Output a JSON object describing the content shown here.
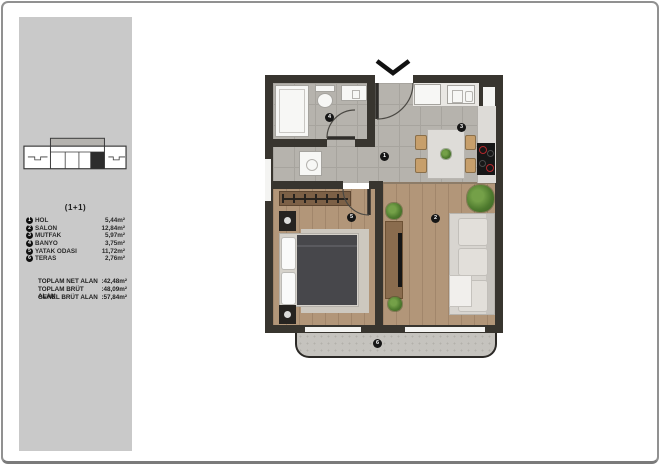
{
  "sidebar": {
    "plan_type": "(1+1)",
    "rooms": [
      {
        "num": "1",
        "label": "HOL",
        "area": "5,44m²"
      },
      {
        "num": "2",
        "label": "SALON",
        "area": "12,84m²"
      },
      {
        "num": "3",
        "label": "MUTFAK",
        "area": "5,97m²"
      },
      {
        "num": "4",
        "label": "BANYO",
        "area": "3,75m²"
      },
      {
        "num": "5",
        "label": "YATAK ODASI",
        "area": "11,72m²"
      },
      {
        "num": "6",
        "label": "TERAS",
        "area": "2,76m²"
      }
    ],
    "totals": [
      {
        "label": "TOPLAM NET ALAN",
        "value": ":42,48m²"
      },
      {
        "label": "TOPLAM BRÜT ALAN",
        "value": ":48,09m²"
      },
      {
        "label": "GENEL BRÜT ALAN",
        "value": ":57,84m²"
      }
    ]
  },
  "floorplan": {
    "markers": {
      "hol": "1",
      "salon": "2",
      "mutfak": "3",
      "banyo": "4",
      "yatak_odasi": "5",
      "teras": "6"
    },
    "colors": {
      "wall": "#38352f",
      "tile_floor": "#b6b3ad",
      "wood_floor": "#b29679",
      "terrace_floor": "#c5c3be",
      "burner_red": "#b3282c",
      "plant_green": "#4e7a2e",
      "sidebar_gray": "#c9c9c9"
    }
  }
}
